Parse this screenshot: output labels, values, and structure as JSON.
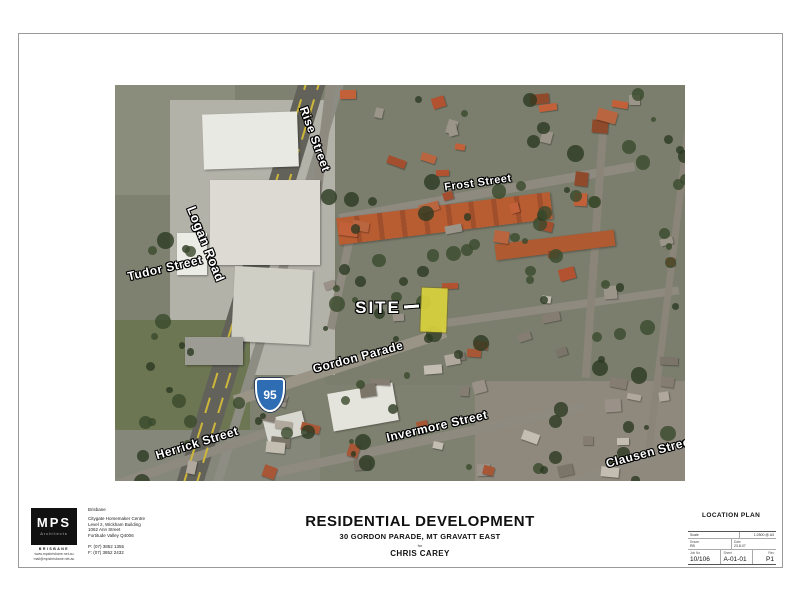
{
  "sheet": {
    "background": "#ffffff"
  },
  "map": {
    "labels": {
      "rise": "Rise Street",
      "frost": "Frost Street",
      "logan": "Logan Road",
      "tudor": "Tudor Street",
      "site": "SITE",
      "gordon": "Gordon Parade",
      "invermore": "Invermore Street",
      "herrick": "Herrick Street",
      "clausen": "Clausen Street",
      "route": "95"
    },
    "colors": {
      "site_highlight": "#d9d23c",
      "route_shield": "#2e6cb3",
      "street_label_text": "#ffffff"
    }
  },
  "title_block": {
    "firm": {
      "logo_main": "MPS",
      "logo_sub": "Architects",
      "logo_caption": "BRISBANE",
      "web_line1": "www.mpsbrisbane.net.au",
      "web_line2": "mail@mpsbrisbane.net.au",
      "office": "Brisbane",
      "address_line1": "Citygate Homemaker Centre",
      "address_line2": "Level 2, Wickham Building",
      "address_line3": "1062 Ann Street",
      "address_line4": "Fortitude Valley Q4006",
      "phone": "P: (07) 3852 1355",
      "fax": "F: (07) 3852 2432"
    },
    "project": {
      "title": "RESIDENTIAL DEVELOPMENT",
      "address": "30 GORDON PARADE, MT GRAVATT EAST",
      "for_label": "for",
      "client": "CHRIS CAREY"
    },
    "drawing": {
      "name": "LOCATION PLAN",
      "scale_label": "Scale",
      "scale_value": "1:2500 @ A3",
      "drawn_label": "Drawn",
      "drawn_value": "RB",
      "date_label": "Date",
      "date_value": "23.8.07",
      "job_label": "Job No",
      "job_value": "10/106",
      "sheet_label": "Sheet",
      "sheet_value": "A-01-01",
      "rev_label": "Rev",
      "rev_value": "P1"
    }
  }
}
